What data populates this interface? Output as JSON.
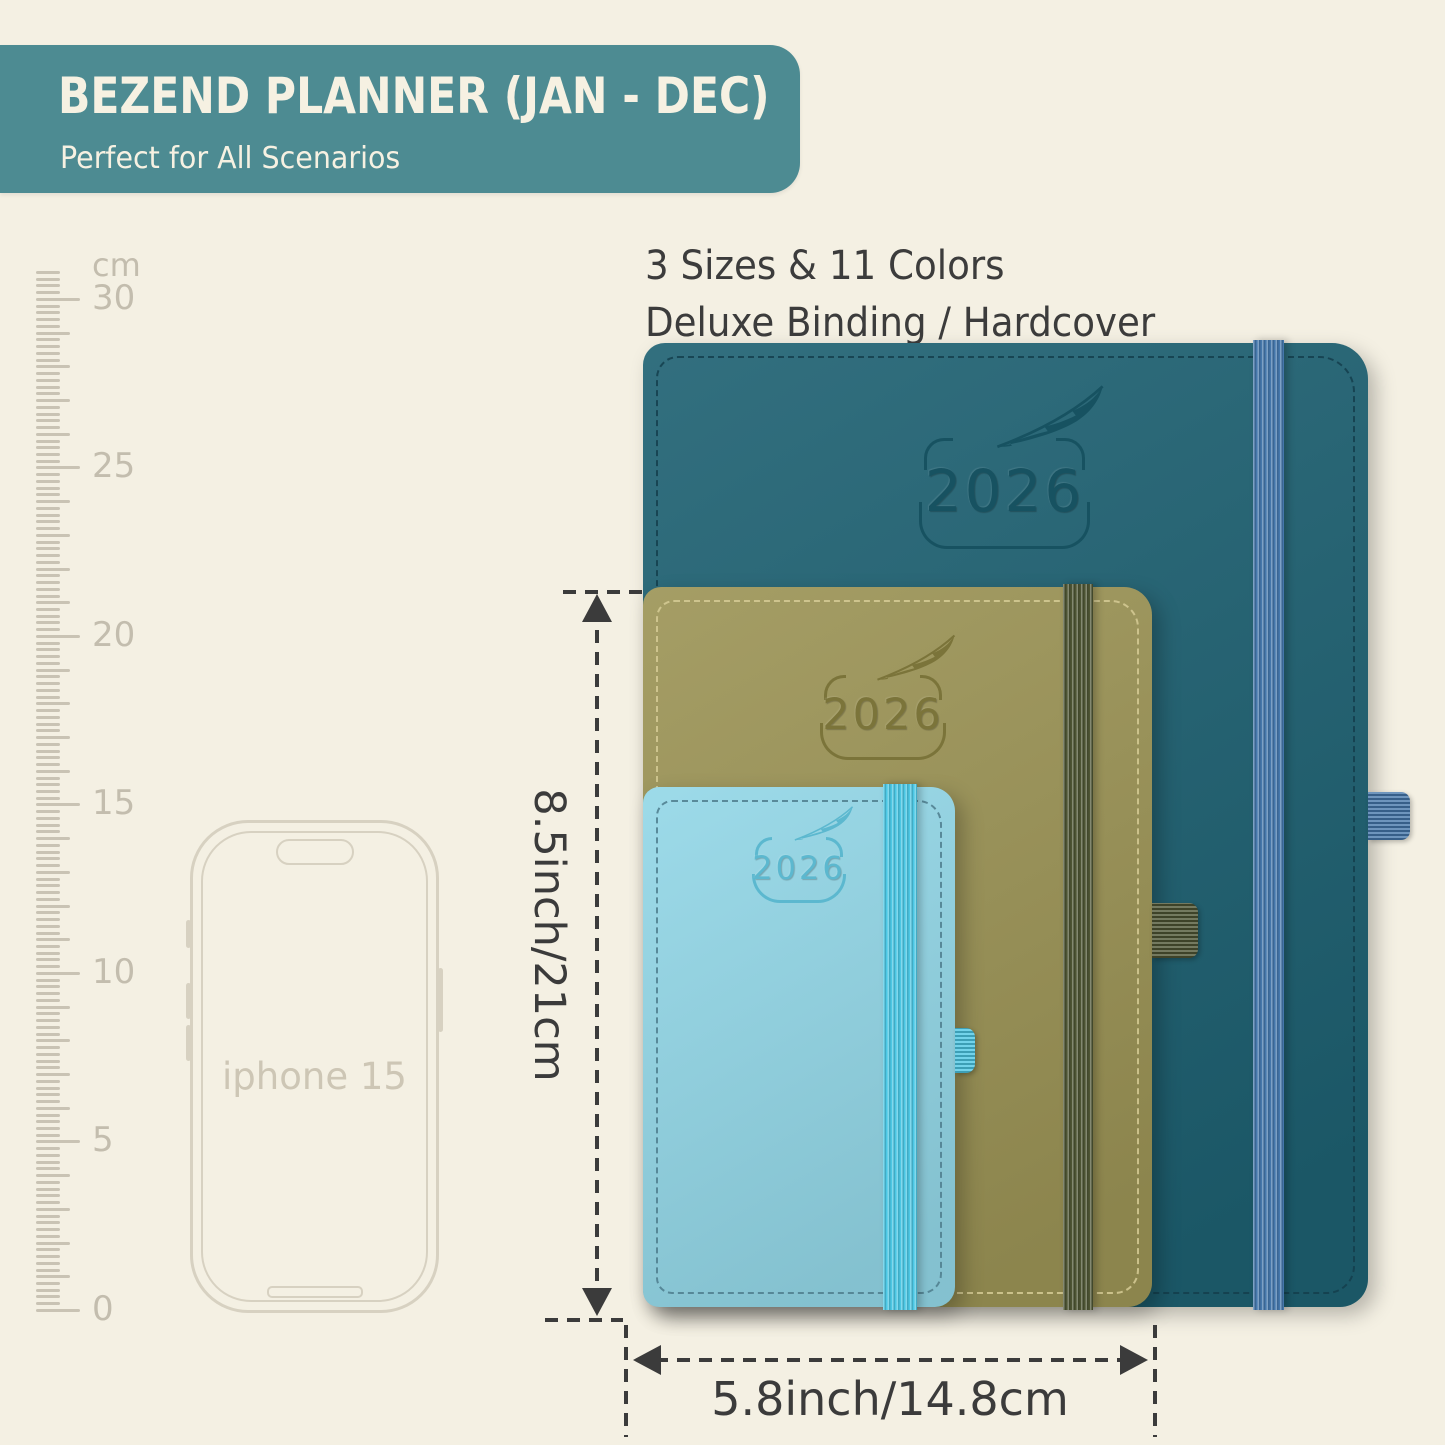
{
  "banner": {
    "title": "BEZEND PLANNER (JAN - DEC)",
    "subtitle": "Perfect for All Scenarios"
  },
  "features": {
    "line1": "3 Sizes & 11 Colors",
    "line2": "Deluxe Binding / Hardcover"
  },
  "ruler": {
    "unit": "cm",
    "max": 30,
    "min": 0,
    "label_step": 5,
    "px_per_cm": 33.7,
    "ticks_per_cm": 5,
    "extra_top_ticks": 4
  },
  "phone": {
    "label": "iphone 15"
  },
  "planners": [
    {
      "id": "large",
      "year": "2026",
      "cover_color": "#1e6172",
      "band_color": "#4577ab",
      "stitch_color": "#143f4d",
      "logo_color": "#175261"
    },
    {
      "id": "medium",
      "year": "2026",
      "cover_color": "#9c9456",
      "band_color": "#4d5433",
      "stitch_color": "#d6cc96",
      "logo_color": "#7b743a"
    },
    {
      "id": "small",
      "year": "2026",
      "cover_color": "#93d7e7",
      "band_color": "#4cc7e4",
      "stitch_color": "#4e7d8d",
      "logo_color": "#5cb8cf"
    }
  ],
  "dimensions": {
    "height_label": "8.5inch/21cm",
    "width_label": "5.8inch/14.8cm"
  },
  "palette": {
    "background": "#f4f0e3",
    "banner_bg": "#4d8b92",
    "banner_text": "#f6f1e2",
    "text_dark": "#3c3c3c",
    "dimension_color": "#3b3b3b",
    "ruler_tick": "#c9c3b4",
    "ruler_text": "#c3bdae",
    "phone_line": "#d7d1c1",
    "phone_text": "#cdc6b5"
  }
}
